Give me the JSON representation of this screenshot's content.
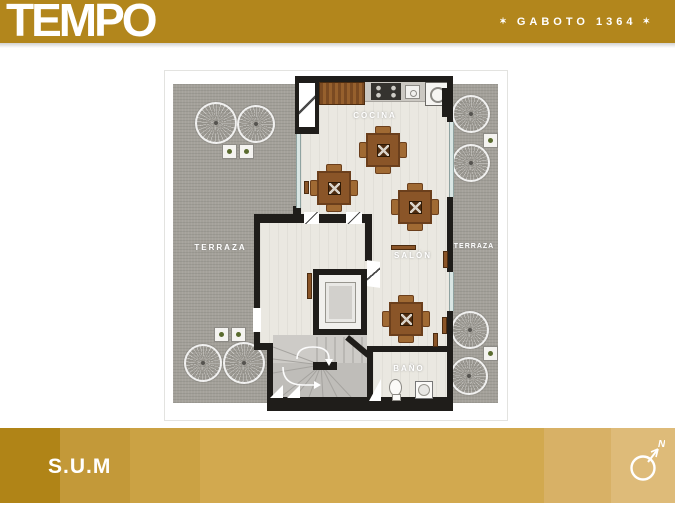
{
  "header": {
    "brand": "TEMPO",
    "project": {
      "star": "✶",
      "name": "GABOTO 1364"
    },
    "background": "#b2861c"
  },
  "plan": {
    "labels": {
      "cocina": "COCINA",
      "terraza_left": "TERRAZA",
      "terraza_right": "TERRAZA",
      "salon": "SALÓN",
      "bano": "BAÑO"
    }
  },
  "footer": {
    "room_title": "S.U.M",
    "compass": "N",
    "segment_colors": [
      "#b08417",
      "#c39939",
      "#cba244",
      "#d2a94f",
      "#d8b166",
      "#debb79"
    ]
  },
  "colors": {
    "header_gold": "#b2861c",
    "wall": "#1f1d1a",
    "floor": "#eae8e1",
    "terrace": "#a4a19a",
    "wood": "#8a5528",
    "glass": "#d9e6e4",
    "text_on_gold": "#ffffff"
  }
}
